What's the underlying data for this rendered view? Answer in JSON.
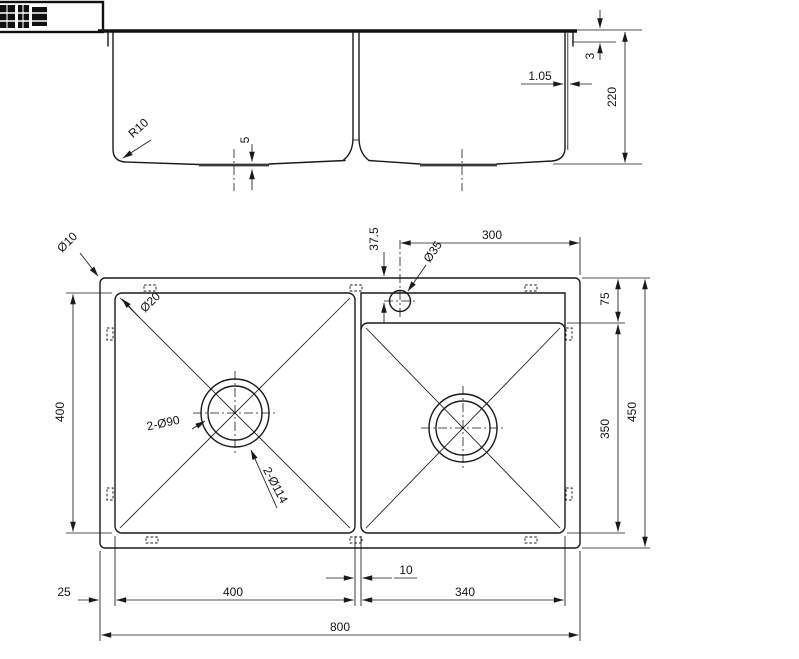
{
  "sheet": {
    "description": "Double bowl kitchen sink technical drawing",
    "logo_present": true
  },
  "colors": {
    "line": "#1a1a1a",
    "background": "#ffffff"
  },
  "side_view": {
    "rim_height": "3",
    "rim_gauge": "1.05",
    "depth": "220",
    "corner_radius": "R10",
    "recess_depth": "5"
  },
  "plan_view": {
    "outer_corner": "Ø10",
    "bowl_corner": "Ø20",
    "faucet_offset": "37.5",
    "faucet_span": "300",
    "faucet_hole": "Ø35",
    "ledge_height": "75",
    "left_bowl_length": "400",
    "right_bowl_length": "350",
    "overall_length": "450",
    "drain_hole": "2-Ø90",
    "drain_flange": "2-Ø114",
    "edge_margin": "25",
    "left_bowl_width": "400",
    "bowl_gap": "10",
    "right_bowl_width": "340",
    "overall_width": "800"
  }
}
